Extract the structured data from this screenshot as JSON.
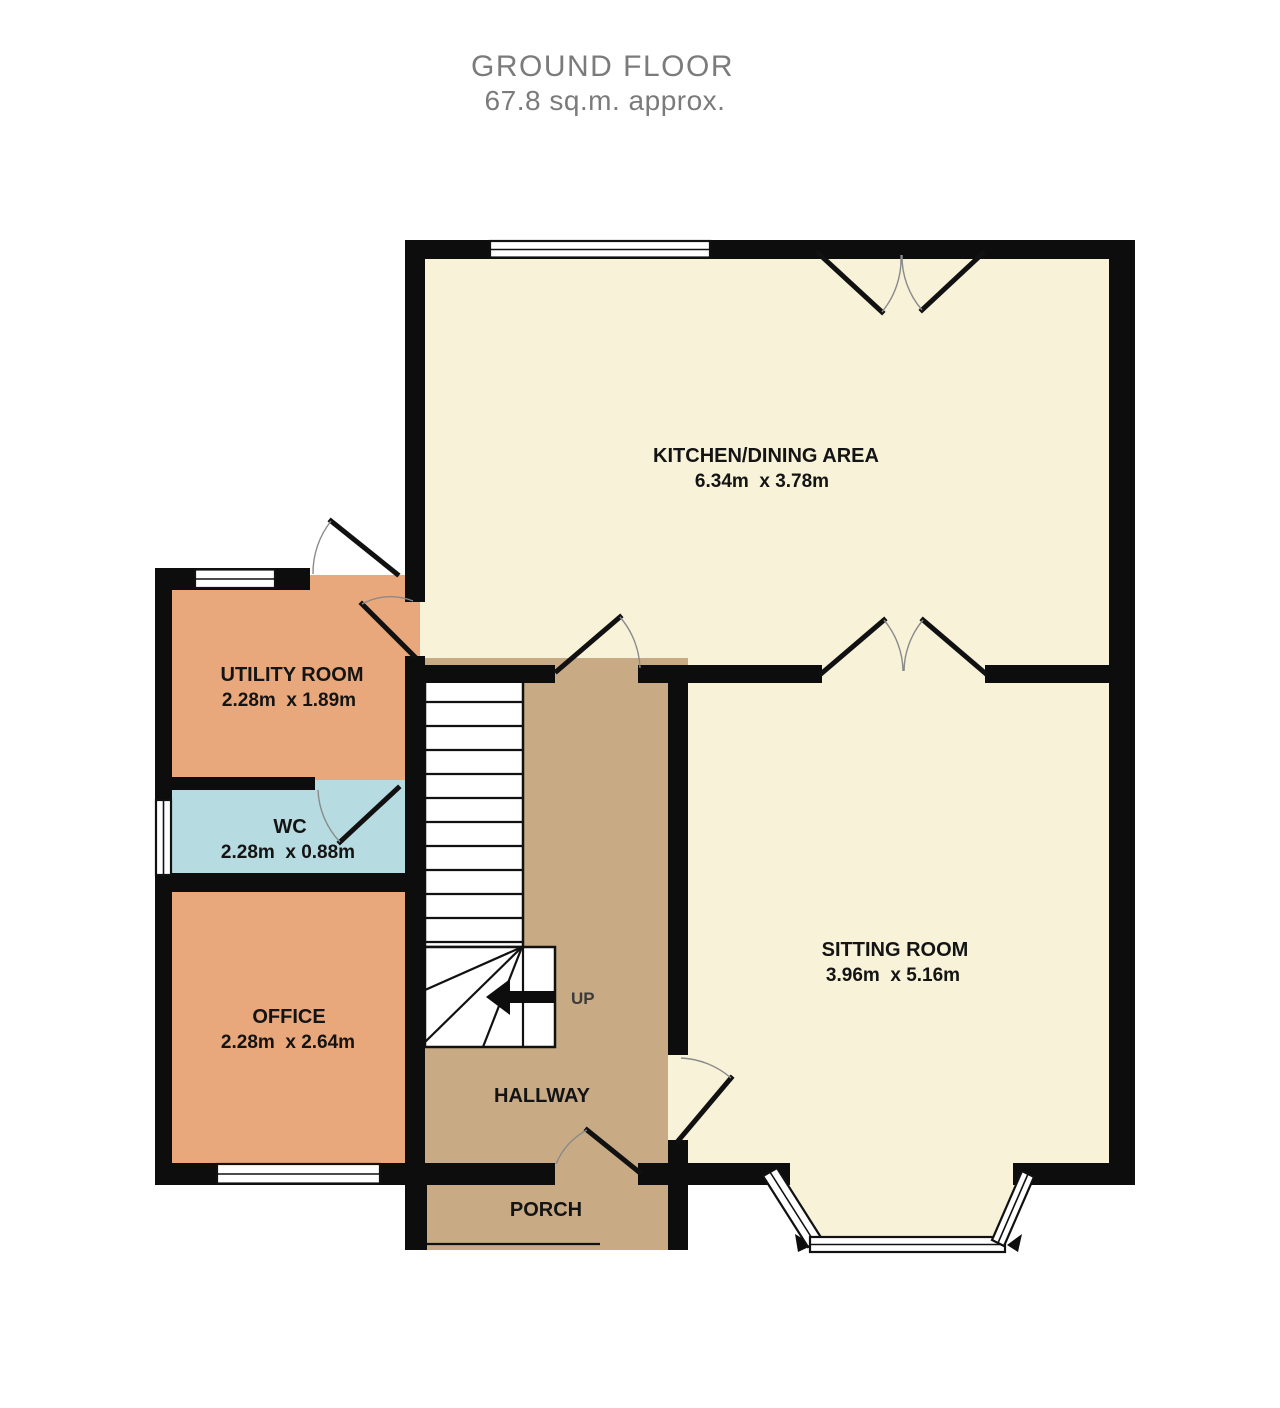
{
  "title": {
    "heading": "GROUND FLOOR",
    "subheading": "67.8 sq.m. approx."
  },
  "rooms": [
    {
      "name": "KITCHEN/DINING AREA",
      "dimensions": "6.34m  x 3.78m",
      "fill": "#f7f2d8"
    },
    {
      "name": "SITTING ROOM",
      "dimensions": "3.96m  x 5.16m",
      "fill": "#f7f2d8"
    },
    {
      "name": "UTILITY ROOM",
      "dimensions": "2.28m  x 1.89m",
      "fill": "#e9a77c"
    },
    {
      "name": "WC",
      "dimensions": "2.28m  x 0.88m",
      "fill": "#b6dbe0"
    },
    {
      "name": "OFFICE",
      "dimensions": "2.28m  x 2.64m",
      "fill": "#e9a77c"
    },
    {
      "name": "HALLWAY",
      "fill": "#c8ab85"
    },
    {
      "name": "PORCH",
      "fill": "#c8ab85"
    }
  ],
  "stairs": {
    "direction_label": "UP"
  },
  "colors": {
    "wall": "#0d0d0d",
    "floor_cream": "#f7f2d8",
    "floor_orange": "#e9a77c",
    "floor_blue": "#b6dbe0",
    "floor_tan": "#c8ab85",
    "door_swing": "#8a8a8a",
    "label_text": "#141414",
    "title_text": "#7b7b7b"
  }
}
